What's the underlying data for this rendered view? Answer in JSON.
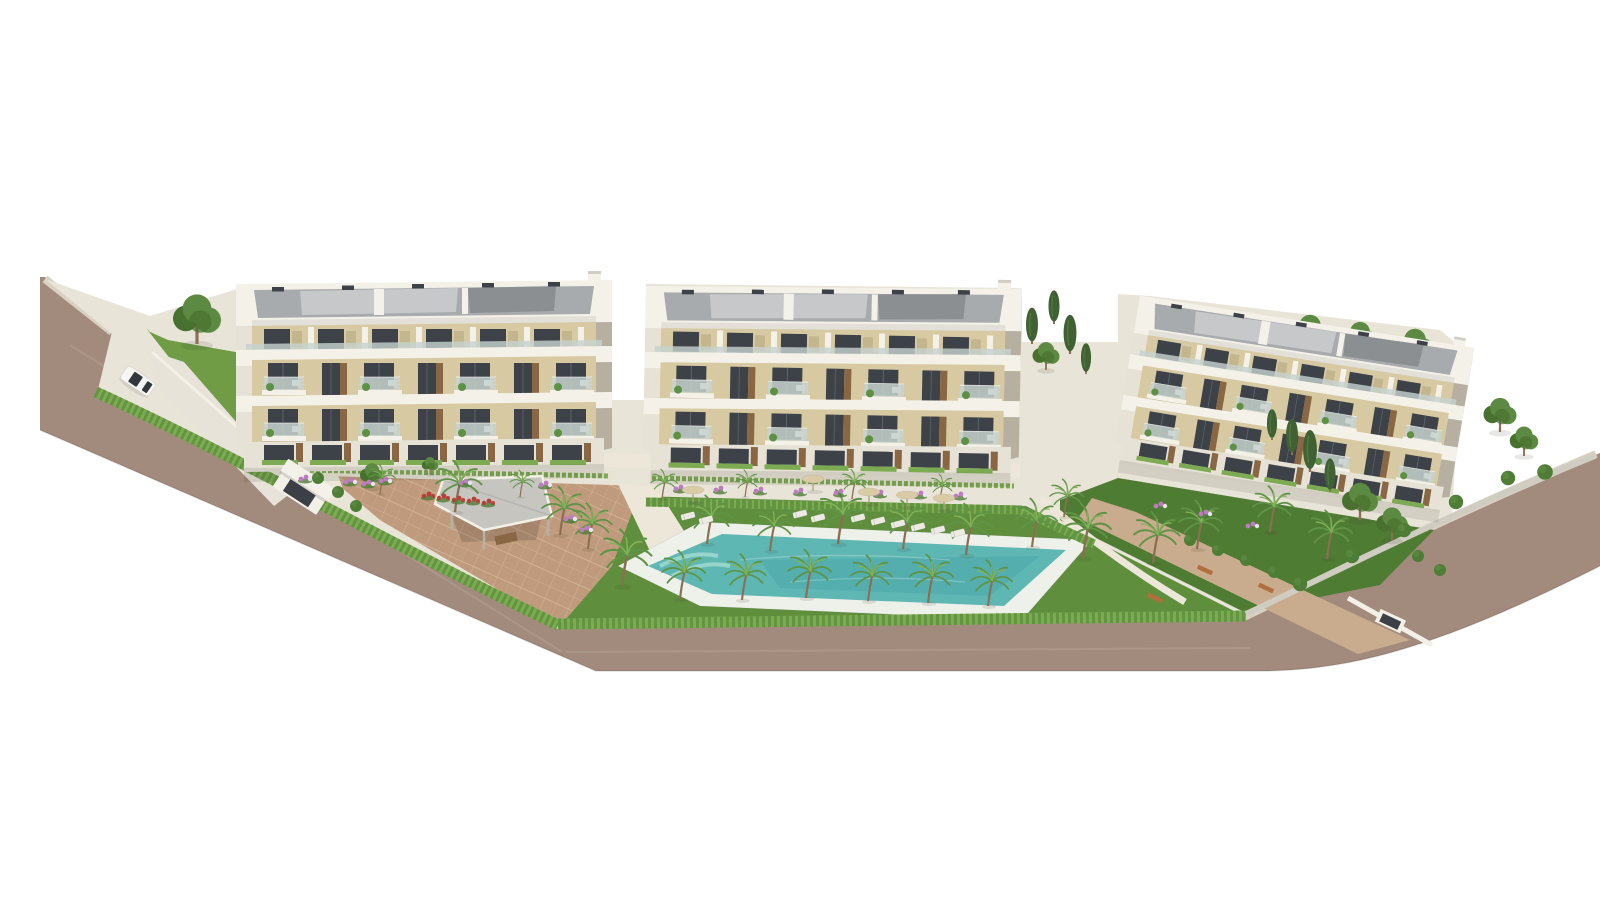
{
  "meta": {
    "type": "architectural-render",
    "title": "Aerial 3D rendering of a residential apartment complex with gardens and pool"
  },
  "scene": {
    "description": "Aerial 3D architectural rendering of a new-build residential complex: three white four-storey apartment buildings with beige facades, glass balconies and roof terraces, landscaped gardens with palm trees, hedges and flower beds, a freeform swimming pool with sun loungers and parasols, a pergola pavilion, an entrance gate with driveway ramp, one white car on the surrounding road, all on a white background.",
    "counts": {
      "buildings": 3,
      "floors_per_building": 4,
      "palm_trees": 26,
      "cypress_trees": 9,
      "deciduous_trees": 10,
      "parasols": 5,
      "sun_loungers": 10,
      "garden_benches": 3,
      "cars": 1,
      "swimming_pools": 1,
      "pergolas": 1,
      "entrance_gates": 2
    }
  },
  "palette": {
    "bg": "#ffffff",
    "road": "#a28b7c",
    "road_line": "rgba(0,0,0,0.12)",
    "sidewalk": "#d8d1c2",
    "ramp": "#e7e3d8",
    "walk": "#ece7d8",
    "court": "#bf9a7c",
    "court_line": "#d2b294",
    "esplanade": "#c9ac8e",
    "lawn": "#5f8f3d",
    "lawn_dark": "#4f7c33",
    "lawn_bright": "#6f9c45",
    "hedge1": "#7cab52",
    "hedge2": "#639441",
    "wall_white": "#f3f0e8",
    "wall_gray": "#cfccc2",
    "pool_deck": "#eef0ea",
    "water": "#5fb7b4",
    "water_deep": "#3f9fa0",
    "water_light": "#a5dbd2",
    "bwhite": "#f4f1e9",
    "bwhite_shade": "#e6e2d5",
    "side_shade": "#b7b0a1",
    "beige": "#d7caa2",
    "beige_dark": "#c3b68e",
    "window": "#3d4248",
    "window_light": "#5d646c",
    "wood": "#8a6744",
    "glass_rail": "#c7d2cf",
    "plant": "#5e9044",
    "roof_light": "#c6c8ca",
    "roof_mid": "#a8abad",
    "roof_dark": "#8b8f92",
    "trunk": "#8b6f52",
    "palm": "#5f9447",
    "palm_light": "#85b258",
    "cypress": "#3f6134",
    "tree": "#5d8a42",
    "tree_dark": "#48702f",
    "bush": "#4e7d35",
    "flower_pink": "#bd7cc0",
    "flower_red": "#b8403c",
    "flower_white": "#e9e4ef",
    "umbrella": "#d8cba6",
    "umbrella_pole": "#a79a73",
    "lounger": "#eceae2",
    "bench": "#b06f3c",
    "car_body": "#f5f5f4",
    "car_glass": "#33383d",
    "shadow": "rgba(60,55,45,0.2)",
    "shadow_soft": "rgba(60,55,45,0.12)",
    "gate_dark": "#3c4046",
    "pergola_roof": "#c6c5c0",
    "pergola_post": "#b4b1a8"
  }
}
